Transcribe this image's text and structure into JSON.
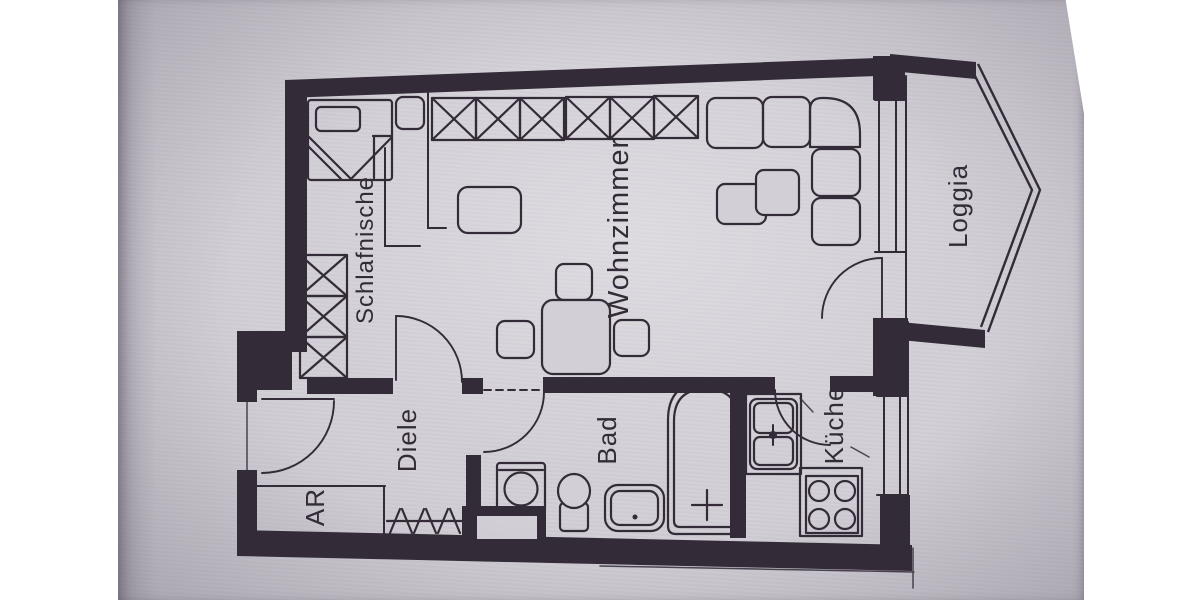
{
  "colors": {
    "paper": "#d3cfd7",
    "ink": "#332c38",
    "margin": "#ffffff"
  },
  "rooms": {
    "schlafnische": {
      "label": "Schlafnische"
    },
    "wohnzimmer": {
      "label": "Wohnzimmer"
    },
    "loggia": {
      "label": "Loggia"
    },
    "diele": {
      "label": "Diele"
    },
    "ar": {
      "label": "AR"
    },
    "bad": {
      "label": "Bad"
    },
    "kueche": {
      "label": "Küche"
    }
  },
  "furniture_icons": [
    "bed",
    "pillow",
    "nightstand",
    "wardrobe-side",
    "wardrobe-top",
    "corner-sofa",
    "coffee-tables",
    "dining-table",
    "chair",
    "armchair",
    "coat-rack",
    "washing-machine",
    "toilet",
    "washbasin",
    "bathtub",
    "kitchen-sink",
    "faucet",
    "stove",
    "window",
    "door-swing",
    "loggia-railing"
  ]
}
